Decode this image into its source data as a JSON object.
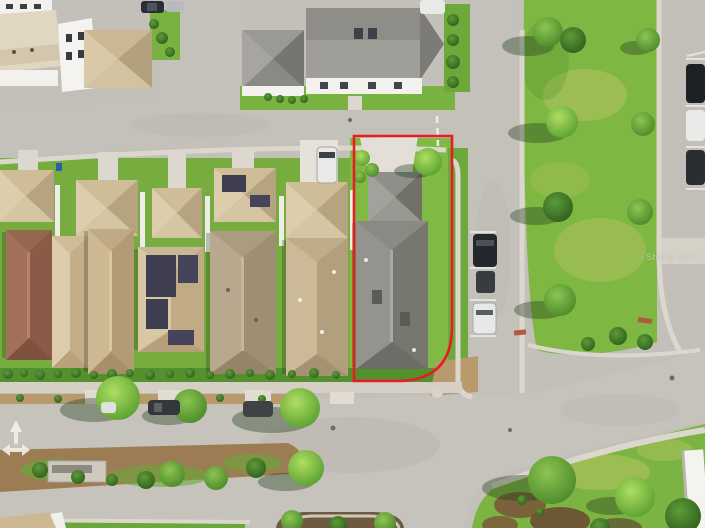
{
  "scene": {
    "type": "aerial-drone-photo",
    "subject": "Aerial view of a suburban neighborhood with the subject property lot outlined in red",
    "watermark": "Stellar MLS",
    "colors": {
      "property_outline": "#e81c24",
      "grass": "#79b240",
      "dry_grass": "#b9c463",
      "road": "#c3bfb9",
      "sidewalk": "#dcd7cd",
      "concrete": "#e3dfd6",
      "roof_tan": "#d3c19d",
      "roof_gray": "#908f8b",
      "roof_brown": "#9c6b50",
      "solar_panel": "#3f3d50",
      "mulch": "#9c7c52"
    },
    "outlined_property": {
      "buildings": 2,
      "roof_color": "gray",
      "lot_shape": "rectangular with rounded street corner at bottom-right"
    },
    "counts": {
      "visible_cars": 13,
      "main_row_houses": 7
    }
  }
}
